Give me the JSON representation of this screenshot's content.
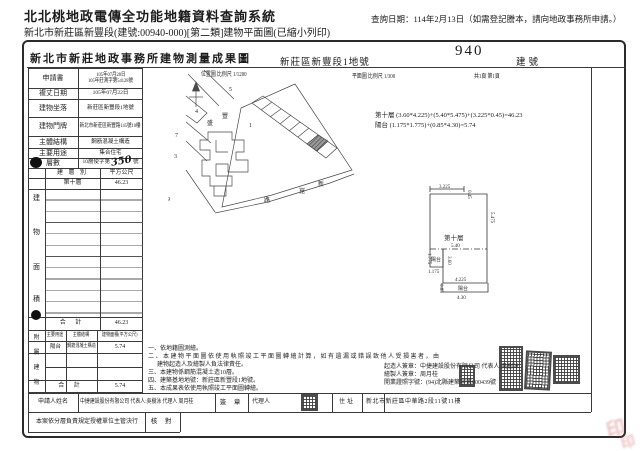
{
  "header": {
    "system_title": "北北桃地政電傳全功能地籍資料查詢系統",
    "query_date": "查詢日期：114年2月13日（如需登記謄本，請向地政事務所申請。）",
    "subtitle": "新北市新莊區新豐段(建號:00940-000)[第二類]建物平面圖(已縮小列印)"
  },
  "sheet": {
    "office_title": "新北市新莊地政事務所建物測量成果圖",
    "land_no": "新莊區新豐段1地號",
    "building_no": "940",
    "building_no_label": "建號",
    "location_scale": "位置圖 比例尺 1/1200",
    "plan_scale": "平面圖 比例尺 1/300",
    "page_info": "共1頁 第1頁"
  },
  "info_table": {
    "r1_label": "申請書",
    "r1_value1": "105年07月28日",
    "r1_value2": "105年莊測字第54128號",
    "r2_label": "複丈日期",
    "r2_value": "105年07月22日",
    "r3_label": "建物坐落",
    "r3_value": "新莊區新豐段1地號",
    "r4_label": "建物門牌",
    "r4_value": "新北市新莊區新豐路145號10樓",
    "r5_label": "主體結構",
    "r5_value": "鋼筋混凝土構造",
    "r6_label": "主要用途",
    "r6_value": "集合住宅",
    "r7_label": "層數",
    "r7_prefix": "10層使字第",
    "r7_hand": "350",
    "r7_suffix": "號"
  },
  "area_table": {
    "section": {
      "c1": "建",
      "c2": "物",
      "c3": "面",
      "c4": "積"
    },
    "head_col1": "建 層 別",
    "head_col2": "平方公尺",
    "floor_name": "第十層",
    "floor_area": "46.23",
    "total_label": "合  計",
    "total_area": "46.23"
  },
  "annex_table": {
    "section": {
      "c1": "附",
      "c2": "屬",
      "c3": "建",
      "c4": "物"
    },
    "head_col1": "主要用途",
    "head_col2": "主體結構",
    "head_col3": "建物面積(平方公尺)",
    "row_use": "陽台",
    "row_structure": "鋼筋混凝土構造",
    "row_area": "5.74",
    "total_label": "合  計",
    "total_area": "5.74"
  },
  "formulas": {
    "line1": "第十層 (3.60*4.225)+(5.40*5.475)+(3.225*0.45)=46.23",
    "line2": "陽台 (1.175*1.775)+(0.85*4.30)=5.74"
  },
  "plan": {
    "room_label": "第十層",
    "room_width": "5.40",
    "balcony_label": "陽台",
    "balcony_h": "1.775",
    "balcony_w": "1.175",
    "dim_top": "3.225",
    "dim_step": "0.45",
    "dim_right": "5.475",
    "dim_inner": "3.60",
    "strip_top": "4.225",
    "strip_label": "陽台",
    "strip_h": "0.85",
    "strip_w": "4.30"
  },
  "map": {
    "p5": "5",
    "p4": "4",
    "p1": "1",
    "p7": "7",
    "p3": "3",
    "p9": "9",
    "s_feng": "豐",
    "s_sheng": "盛",
    "s_xin": "新",
    "s_kun": "崑",
    "s_lu": "路"
  },
  "notes": {
    "n1": "一、依地籍圖測繪。",
    "n2": "二、本建物平面圖依使用執照竣工平面圖轉繪計算，如有遺漏或錯誤致他人受損害者，由",
    "n3": "建物起造人及繪製人負法律責任。",
    "n4": "三、本建物係鋼筋混凝土造10層。",
    "n5": "四、建築基地地號：新莊區新豐段1地號。",
    "n6": "五、本成果表依使用執照竣工平面圖轉繪。",
    "s1": "起造人簽章：中捷建設股份有限公司 代表人:吳樹泳",
    "s2": "繪製人簽章：周月桂",
    "s3": "開業證照字號：(94)北縣建築字第000439號"
  },
  "footer": {
    "applicant_label": "申請人姓名",
    "applicant_value": "中捷建設股份有限公司 代表人:吳樹泳 代理人 周月桂",
    "sign_label": "簽 章",
    "agent_label": "代理人",
    "address_label": "住址",
    "address_value": "新北市新莊區中華路2段11號11樓",
    "delegation": "本案依分層負責規定授權單位主管決行",
    "check_label": "核 對"
  },
  "corner_seal": "印"
}
